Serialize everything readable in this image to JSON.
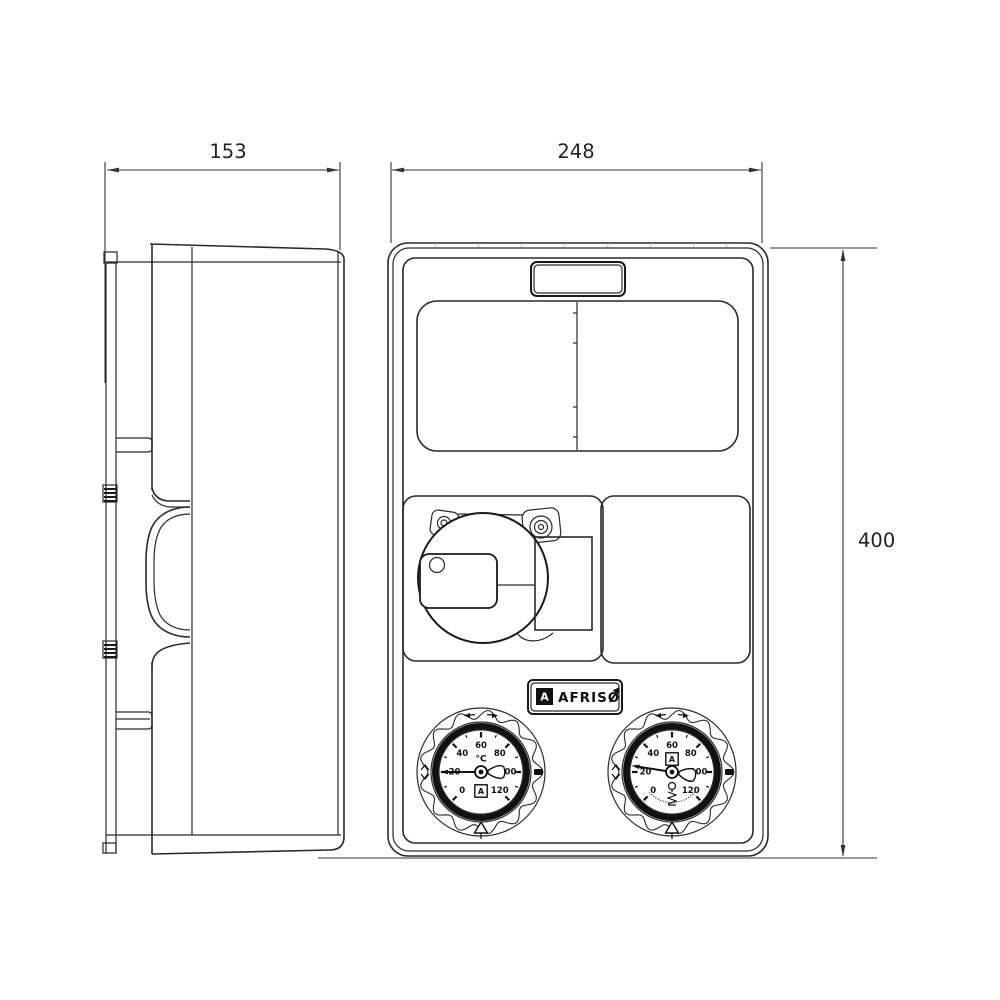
{
  "drawing": {
    "dimensions": {
      "side_width": "153",
      "front_width": "248",
      "height": "400"
    },
    "logo": {
      "mark": "A",
      "text": "AFRISO"
    },
    "gauge": {
      "unit": "°C",
      "scale_labels": [
        "0",
        "20",
        "40",
        "60",
        "80",
        "100",
        "120"
      ],
      "scale_angles_deg": [
        225,
        180,
        135,
        90,
        45,
        0,
        315
      ],
      "left": {
        "needle_angle_deg": 180,
        "show_unit": true,
        "logo_position": "below",
        "valve_symbol": false
      },
      "right": {
        "needle_angle_deg": 189,
        "show_unit": false,
        "logo_position": "above",
        "valve_symbol": true
      }
    }
  }
}
